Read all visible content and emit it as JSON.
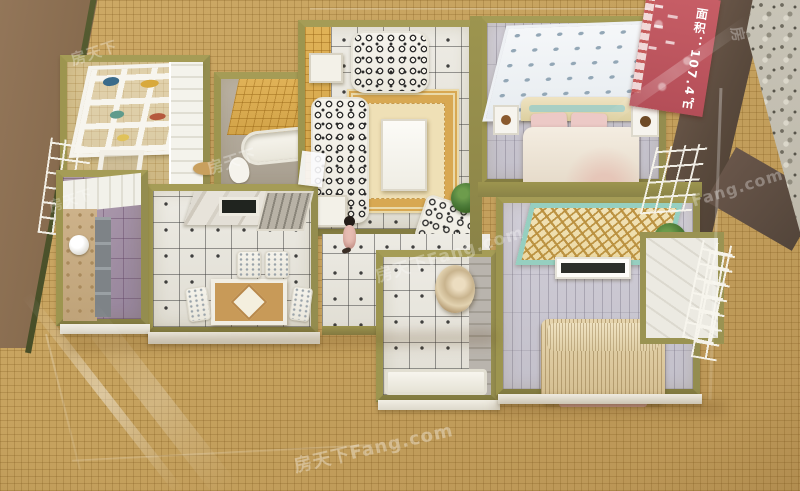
{
  "image": {
    "type": "photograph",
    "subject": "miniature apartment scale model (cut-away floor plan) under glass on a woven mat table",
    "width": 800,
    "height": 491
  },
  "watermark": {
    "brand": "房天下Fang.com",
    "cjk": "房天下",
    "latin": "Fang.com",
    "single": "房"
  },
  "sign": {
    "area_text": "面积：107.4㎡",
    "bg_color": "#c05660",
    "text_color": "#ffffff"
  },
  "colors": {
    "mat_tan": "#c6a260",
    "wall_top_olive": "#948d4f",
    "wood_board": "#876b4e",
    "table_edge": "#5a4a3d",
    "terrazzo": "#c3bfb2",
    "rug_gold": "#d8a852",
    "bed_pink": "#ecc9c6",
    "panel_teal": "#96cfc0",
    "lattice_gold": "#ba903e",
    "plant_green": "#4e7d3a",
    "purple_tile": "#a794a8"
  },
  "rooms": [
    {
      "name": "wardrobe-room"
    },
    {
      "name": "small-bathroom"
    },
    {
      "name": "living-room"
    },
    {
      "name": "dining-room"
    },
    {
      "name": "left-bathroom"
    },
    {
      "name": "hallway"
    },
    {
      "name": "bottom-bathroom"
    },
    {
      "name": "master-bedroom"
    },
    {
      "name": "second-bedroom"
    },
    {
      "name": "balcony"
    }
  ]
}
